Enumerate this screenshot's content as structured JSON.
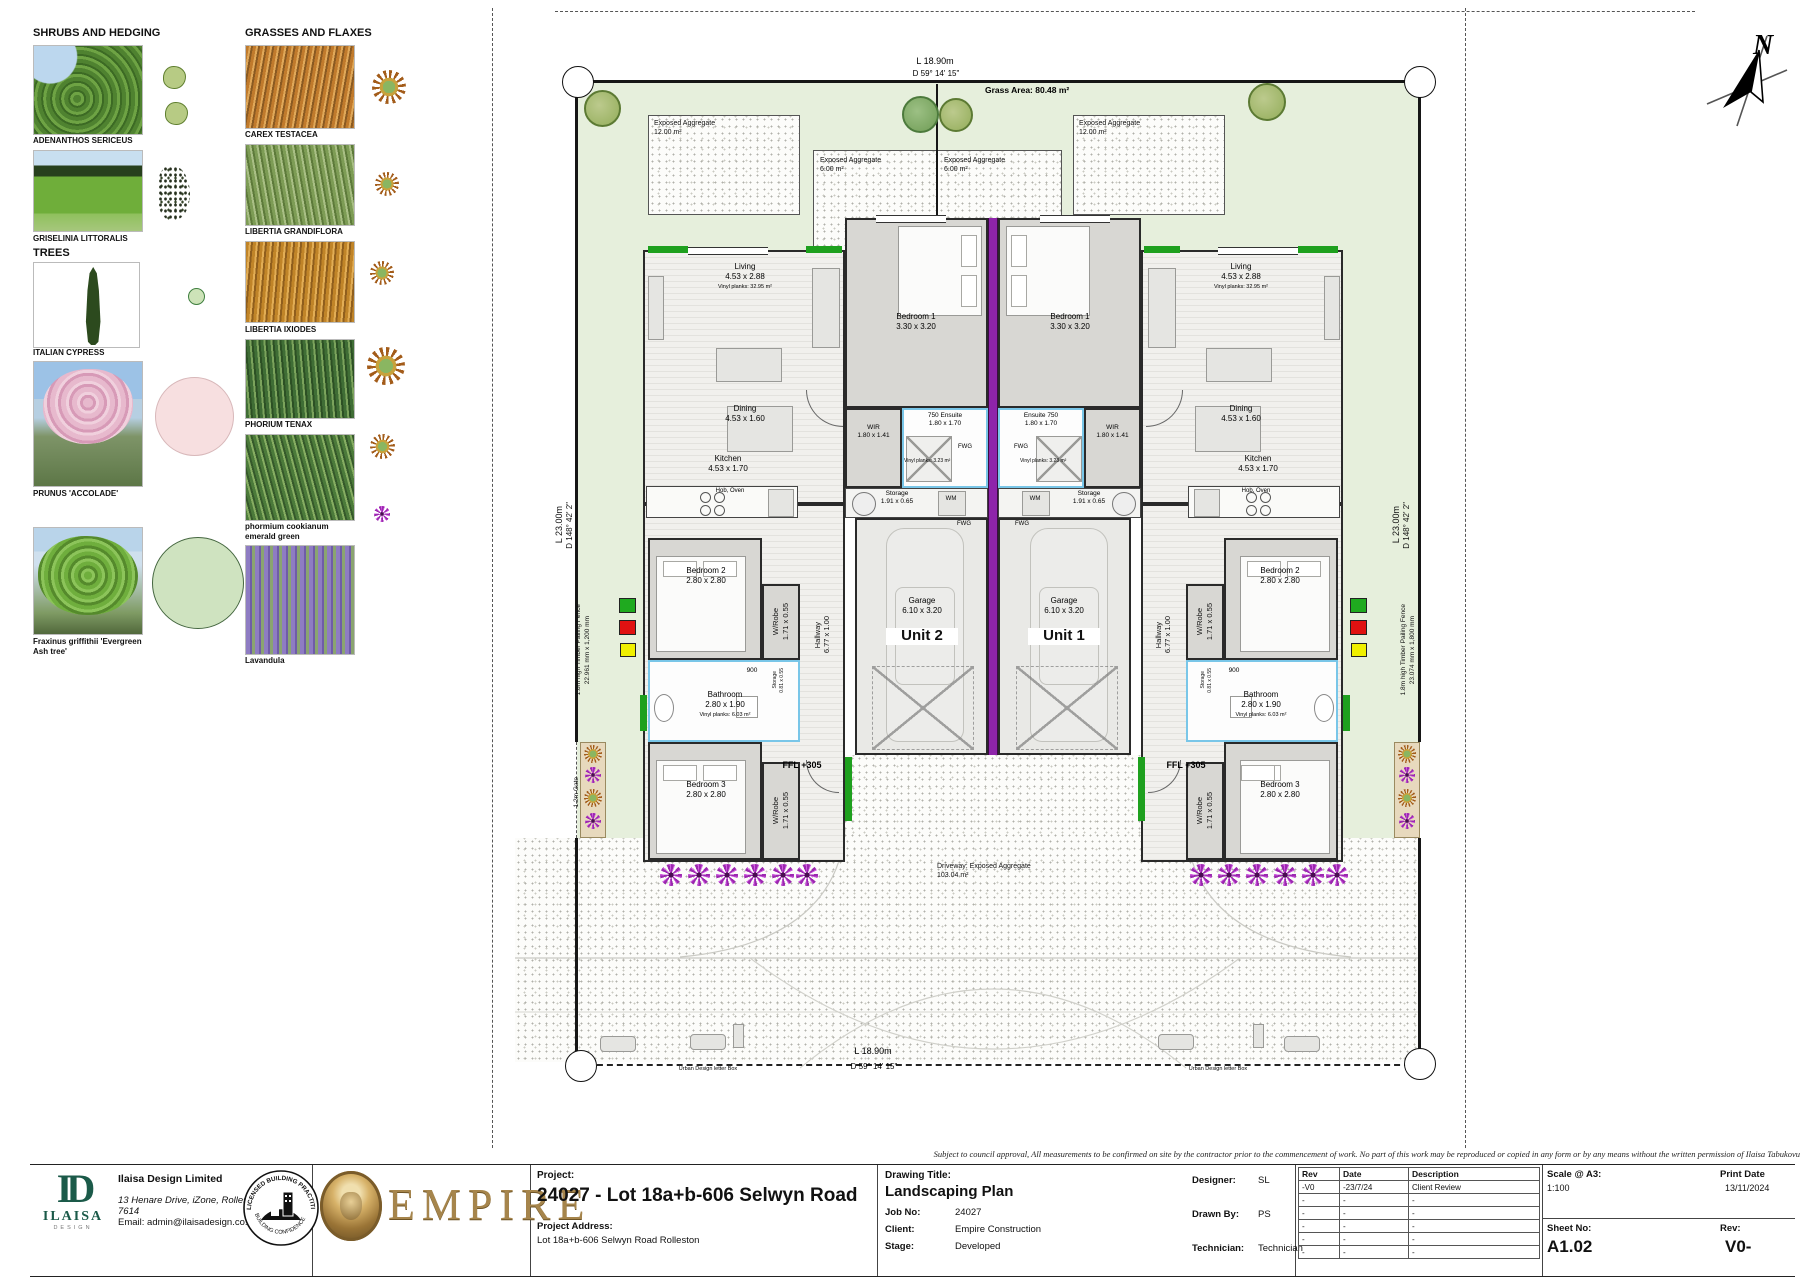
{
  "legend": {
    "sh rubs": "x",
    "shrubs_heading": "SHRUBS AND HEDGING",
    "trees_heading": "TREES",
    "grasses_heading": "GRASSES AND FLAXES",
    "shrubs": [
      {
        "name": "ADENANTHOS SERICEUS"
      },
      {
        "name": "GRISELINIA LITTORALIS"
      }
    ],
    "trees": [
      {
        "name": "ITALIAN CYPRESS"
      },
      {
        "name": "PRUNUS 'ACCOLADE'"
      },
      {
        "name": "Fraxinus griffithii 'Evergreen Ash tree'"
      }
    ],
    "grasses": [
      {
        "name": "CAREX TESTACEA"
      },
      {
        "name": "LIBERTIA GRANDIFLORA"
      },
      {
        "name": "LIBERTIA IXIODES"
      },
      {
        "name": "PHORIUM TENAX"
      },
      {
        "name": "phormium cookianum emerald green"
      },
      {
        "name": "Lavandula"
      }
    ]
  },
  "site": {
    "north": "N",
    "grass_area": "Grass Area: 80.48 m²",
    "dim_width": {
      "length": "L 18.90m",
      "bearing": "D 59° 14' 15\""
    },
    "dim_depth": {
      "length": "L 23.00m",
      "bearing": "D 148° 42' 2\""
    },
    "aggregate_12": {
      "line1": "Exposed Aggregate",
      "line2": "12.00 m²"
    },
    "aggregate_6": {
      "line1": "Exposed Aggregate",
      "line2": "6.00 m²"
    },
    "driveway": {
      "line1": "Driveway: Exposed Aggregate",
      "line2": "103.04 m²"
    },
    "fence_left": {
      "fence": "1.8m high Timber Pailing Fence",
      "fence_size": "22.961 mm x 1,200 mm",
      "gate": "1.2m Gate",
      "gate_size": "810 mm x 1,200 mm"
    },
    "fence_right": {
      "fence": "1.8m high Timber Pailing Fence",
      "fence_size": "23.074 mm x 1,800 mm",
      "gate": "1.2m Gate",
      "gate_size": "810 mm x 1,800 mm"
    },
    "letterbox": "Urban Design letter Box",
    "ffl": "FFL +305"
  },
  "rooms": {
    "living": {
      "name": "Living",
      "size": "4.53 x 2.88",
      "note": "Vinyl planks: 32.95 m²"
    },
    "dining": {
      "name": "Dining",
      "size": "4.53 x 1.60"
    },
    "kitchen": {
      "name": "Kitchen",
      "size": "4.53 x 1.70",
      "note": "Hob, Oven"
    },
    "bedroom1": {
      "name": "Bedroom 1",
      "size": "3.30 x 3.20"
    },
    "bedroom2": {
      "name": "Bedroom 2",
      "size": "2.80 x 2.80"
    },
    "bedroom3": {
      "name": "Bedroom 3",
      "size": "2.80 x 2.80"
    },
    "bathroom": {
      "name": "Bathroom",
      "size": "2.80 x 1.90",
      "note": "Vinyl planks: 6.03 m²",
      "d900": "900"
    },
    "ensuite_left": {
      "name": "750 Ensuite",
      "size": "1.80 x 1.70",
      "note": "Vinyl planks: 3.23 m²"
    },
    "ensuite_right": {
      "name": "Ensuite 750",
      "size": "1.80 x 1.70",
      "note": "Vinyl planks: 3.23 m²"
    },
    "wir": {
      "name": "WIR",
      "size": "1.80 x 1.41"
    },
    "wrobe": {
      "name": "W/Robe",
      "size": "1.71 x 0.55"
    },
    "hallway": {
      "name": "Hallway",
      "size": "6.77 x 1.00"
    },
    "storage": {
      "name": "Storage",
      "size": "1.91 x 0.65"
    },
    "storage_small": {
      "name": "Storage",
      "size": "0.81 x 0.55"
    },
    "garage": {
      "name": "Garage",
      "size": "6.10 x 3.20"
    },
    "wm": "WM",
    "fwg": "FWG"
  },
  "units": {
    "unit1": "Unit 1",
    "unit2": "Unit 2"
  },
  "title_block": {
    "company": {
      "name": "Ilaisa Design Limited",
      "address": "13 Henare Drive, iZone, Rolleston",
      "address2": "7614",
      "email": "Email: admin@ilaisadesign.co.nz",
      "monogram": "ID",
      "logo_name": "ILAISA",
      "logo_sub": "DESIGN"
    },
    "badge_top": "LICENSED BUILDING PRACTITIONERS",
    "badge_bottom": "BUILDING CONFIDENCE",
    "empire": "EMPIRE",
    "project_label": "Project:",
    "project_title": "24027 - Lot 18a+b-606 Selwyn Road",
    "address_label": "Project Address:",
    "project_address": "Lot 18a+b-606 Selwyn Road Rolleston",
    "drawing_label": "Drawing Title:",
    "drawing_title": "Landscaping Plan",
    "job_label": "Job No:",
    "job_no": "24027",
    "client_label": "Client:",
    "client": "Empire Construction",
    "stage_label": "Stage:",
    "stage": "Developed",
    "designer_label": "Designer:",
    "designer": "SL",
    "drawn_label": "Drawn By:",
    "drawn_by": "PS",
    "technician_label": "Technician:",
    "technician": "Technician",
    "rev_table": {
      "headers": [
        "Rev",
        "Date",
        "Description"
      ],
      "rows": [
        [
          "-V0",
          "-23/7/24",
          "Client Review"
        ],
        [
          "-",
          "-",
          "-"
        ],
        [
          "-",
          "-",
          "-"
        ],
        [
          "-",
          "-",
          "-"
        ],
        [
          "-",
          "-",
          "-"
        ],
        [
          "-",
          "-",
          "-"
        ]
      ]
    },
    "scale_label": "Scale @ A3:",
    "scale": "1:100",
    "print_label": "Print Date",
    "print_date": "13/11/2024",
    "sheet_label": "Sheet No:",
    "sheet_no": "A1.02",
    "rev_label": "Rev:",
    "rev": "V0-",
    "disclaimer": "Subject to council approval, All measurements to be confirmed on site by the contractor prior to the commencement of work. No part of this work may be reproduced or copied in any form or by any means without the written permission of Ilaisa Tabukovu"
  },
  "colors": {
    "party_wall": "#8e24aa",
    "grass": "#e6efdc",
    "accent_green": "#1ea01e",
    "marker_red": "#e01111",
    "marker_yellow": "#f0f000"
  }
}
